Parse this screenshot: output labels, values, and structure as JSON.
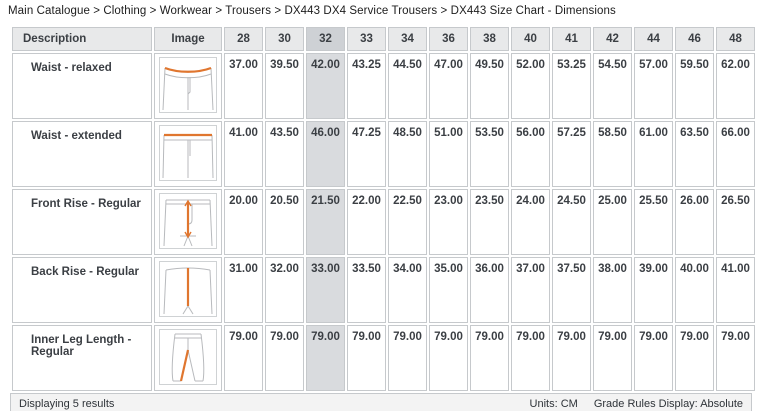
{
  "breadcrumb": "Main Catalogue > Clothing > Workwear > Trousers > DX443 DX4 Service Trousers > DX443 Size Chart - Dimensions",
  "colors": {
    "accent_orange": "#e0762f",
    "header_bg": "#e8e9ea",
    "header_highlight_bg": "#ced1d5",
    "column_highlight_bg": "#d9dbde",
    "border": "#c6c9cc"
  },
  "chart_data": {
    "type": "table",
    "title": "DX443 Size Chart - Dimensions",
    "units": "CM",
    "highlighted_size": "32",
    "sizes": [
      "28",
      "30",
      "32",
      "33",
      "34",
      "36",
      "38",
      "40",
      "41",
      "42",
      "44",
      "46",
      "48"
    ],
    "series": [
      {
        "name": "Waist - relaxed",
        "values": [
          37.0,
          39.5,
          42.0,
          43.25,
          44.5,
          47.0,
          49.5,
          52.0,
          53.25,
          54.5,
          57.0,
          59.5,
          62.0
        ]
      },
      {
        "name": "Waist - extended",
        "values": [
          41.0,
          43.5,
          46.0,
          47.25,
          48.5,
          51.0,
          53.5,
          56.0,
          57.25,
          58.5,
          61.0,
          63.5,
          66.0
        ]
      },
      {
        "name": "Front Rise - Regular",
        "values": [
          20.0,
          20.5,
          21.5,
          22.0,
          22.5,
          23.0,
          23.5,
          24.0,
          24.5,
          25.0,
          25.5,
          26.0,
          26.5
        ]
      },
      {
        "name": "Back Rise - Regular",
        "values": [
          31.0,
          32.0,
          33.0,
          33.5,
          34.0,
          35.0,
          36.0,
          37.0,
          37.5,
          38.0,
          39.0,
          40.0,
          41.0
        ]
      },
      {
        "name": "Inner Leg Length - Regular",
        "values": [
          79.0,
          79.0,
          79.0,
          79.0,
          79.0,
          79.0,
          79.0,
          79.0,
          79.0,
          79.0,
          79.0,
          79.0,
          79.0
        ]
      }
    ]
  },
  "table": {
    "headers": {
      "description": "Description",
      "image": "Image"
    },
    "sizes": [
      "28",
      "30",
      "32",
      "33",
      "34",
      "36",
      "38",
      "40",
      "41",
      "42",
      "44",
      "46",
      "48"
    ],
    "rows": [
      {
        "description": "Waist - relaxed",
        "image_icon": "trousers-waist-relaxed-icon",
        "values": [
          "37.00",
          "39.50",
          "42.00",
          "43.25",
          "44.50",
          "47.00",
          "49.50",
          "52.00",
          "53.25",
          "54.50",
          "57.00",
          "59.50",
          "62.00"
        ]
      },
      {
        "description": "Waist - extended",
        "image_icon": "trousers-waist-extended-icon",
        "values": [
          "41.00",
          "43.50",
          "46.00",
          "47.25",
          "48.50",
          "51.00",
          "53.50",
          "56.00",
          "57.25",
          "58.50",
          "61.00",
          "63.50",
          "66.00"
        ]
      },
      {
        "description": "Front Rise - Regular",
        "image_icon": "trousers-front-rise-icon",
        "values": [
          "20.00",
          "20.50",
          "21.50",
          "22.00",
          "22.50",
          "23.00",
          "23.50",
          "24.00",
          "24.50",
          "25.00",
          "25.50",
          "26.00",
          "26.50"
        ]
      },
      {
        "description": "Back Rise - Regular",
        "image_icon": "trousers-back-rise-icon",
        "values": [
          "31.00",
          "32.00",
          "33.00",
          "33.50",
          "34.00",
          "35.00",
          "36.00",
          "37.00",
          "37.50",
          "38.00",
          "39.00",
          "40.00",
          "41.00"
        ]
      },
      {
        "description": "Inner Leg Length - Regular",
        "image_icon": "trousers-inner-leg-icon",
        "values": [
          "79.00",
          "79.00",
          "79.00",
          "79.00",
          "79.00",
          "79.00",
          "79.00",
          "79.00",
          "79.00",
          "79.00",
          "79.00",
          "79.00",
          "79.00"
        ]
      }
    ]
  },
  "footer": {
    "displaying": "Displaying 5 results",
    "units": "Units: CM",
    "grade_rules": "Grade Rules Display: Absolute"
  }
}
